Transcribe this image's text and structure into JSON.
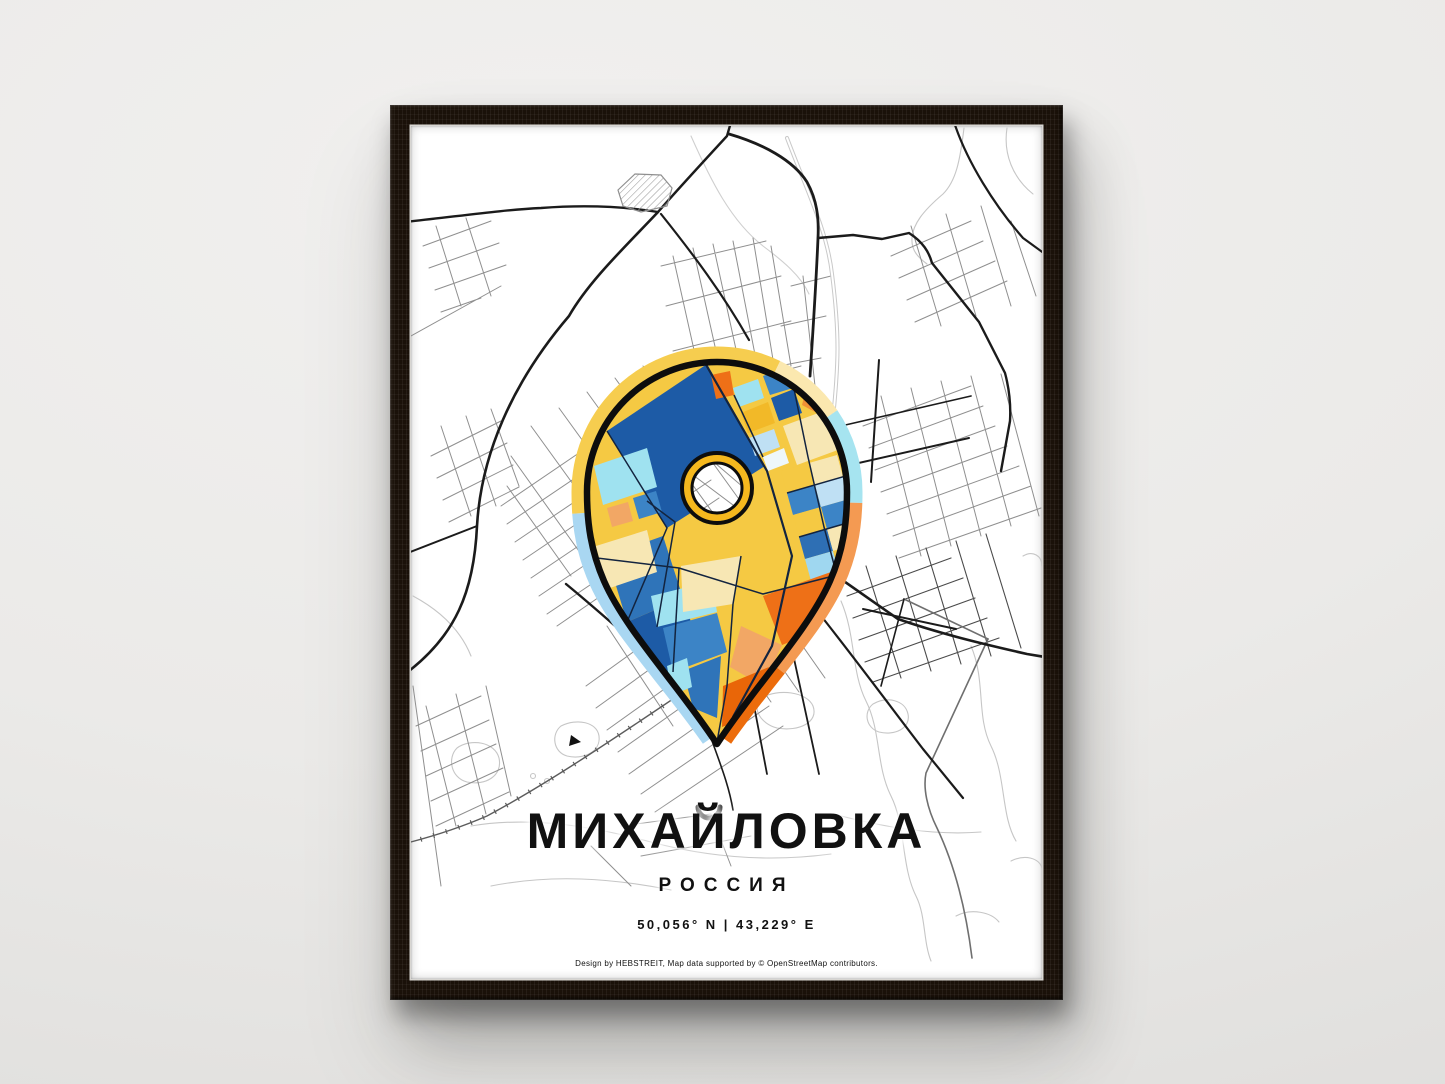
{
  "poster": {
    "title": "МИХАЙЛОВКА",
    "country": "РОССИЯ",
    "coordinates": "50,056° N | 43,229° E",
    "credit": "Design by HEBSTREIT, Map data supported by © OpenStreetMap contributors."
  },
  "icons": {
    "pin": "location-pin-icon",
    "ring": "pin-center-ring"
  },
  "colors": {
    "wall": "#ececea",
    "frame_wood": "#1a1109",
    "paper": "#ffffff",
    "road_black": "#1b1b1b",
    "street_gray": "#8f8f8f",
    "water_gray": "#c6c6c6",
    "band_yellow": "#f6cd4f",
    "band_cream": "#fbe8af",
    "band_cyan": "#a6e4f0",
    "band_light_blue": "#a9d7f2",
    "band_orange": "#f49a52",
    "band_deep_orange": "#ec6c0c",
    "ring_gold": "#f5b81e",
    "mosaic_dark_blue": "#1d5ba6",
    "mosaic_blue": "#3c84c6",
    "mosaic_light_blue": "#bfe0f4",
    "mosaic_cyan": "#9fe2f0",
    "mosaic_gold": "#f5c943",
    "mosaic_pale_yellow": "#f7e7b4",
    "mosaic_orange": "#ee7017",
    "mosaic_salmon": "#f2a765"
  }
}
